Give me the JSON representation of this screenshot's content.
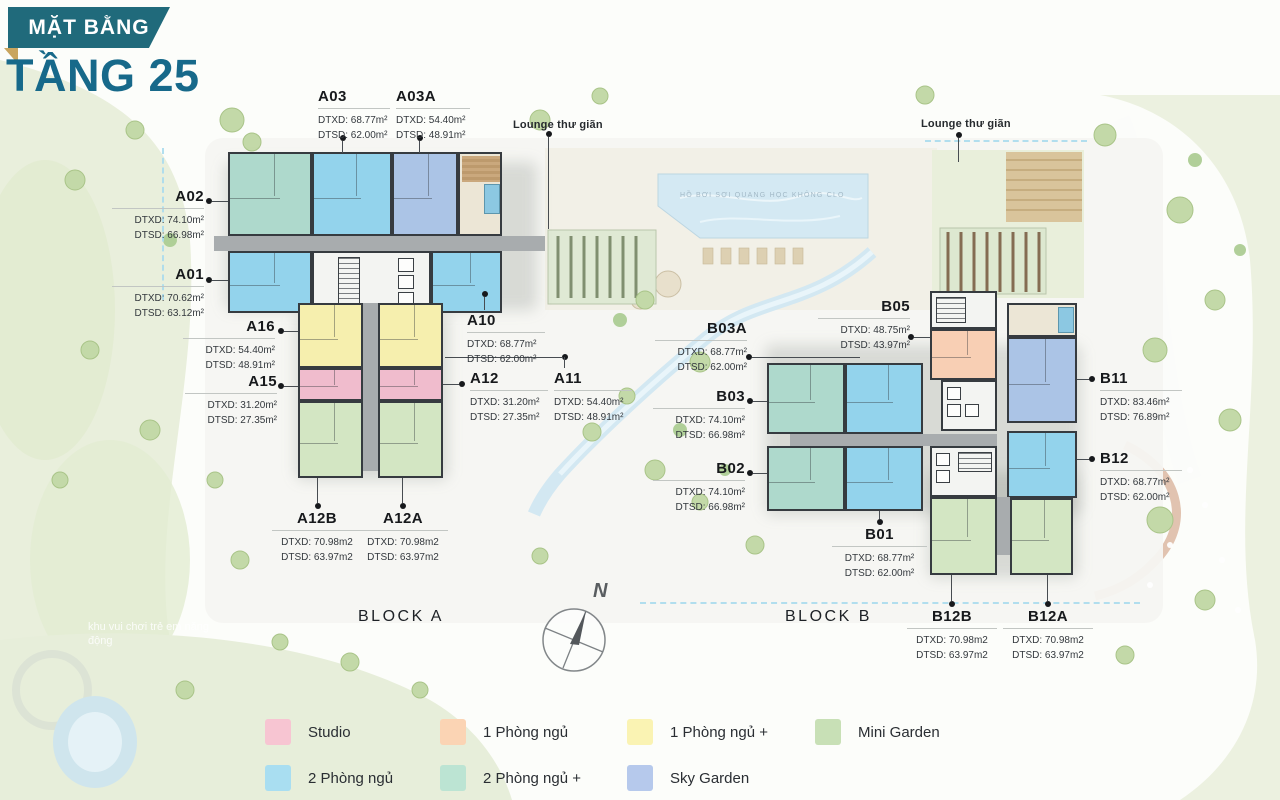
{
  "title": {
    "ribbon": "MẶT BẰNG",
    "floor": "TẦNG 25"
  },
  "annotations": {
    "lounge_left": "Lounge thư giãn",
    "lounge_right": "Lounge thư giãn",
    "block_a": "BLOCK A",
    "block_b": "BLOCK B",
    "compass_north": "N",
    "pool_caption": "HỒ BƠI SỢI QUANG HỌC KHÔNG CLO",
    "playground_caption": "khu vui chơi trẻ em năng động"
  },
  "units": {
    "A01": {
      "name": "A01",
      "dtxd": "DTXD: 70.62m²",
      "dtsd": "DTSD: 63.12m²"
    },
    "A02": {
      "name": "A02",
      "dtxd": "DTXD: 74.10m²",
      "dtsd": "DTSD: 66.98m²"
    },
    "A03": {
      "name": "A03",
      "dtxd": "DTXD: 68.77m²",
      "dtsd": "DTSD: 62.00m²"
    },
    "A03A": {
      "name": "A03A",
      "dtxd": "DTXD: 54.40m²",
      "dtsd": "DTSD: 48.91m²"
    },
    "A10": {
      "name": "A10",
      "dtxd": "DTXD: 68.77m²",
      "dtsd": "DTSD: 62.00m²"
    },
    "A11": {
      "name": "A11",
      "dtxd": "DTXD: 54.40m²",
      "dtsd": "DTSD: 48.91m²"
    },
    "A12": {
      "name": "A12",
      "dtxd": "DTXD: 31.20m²",
      "dtsd": "DTSD: 27.35m²"
    },
    "A15": {
      "name": "A15",
      "dtxd": "DTXD: 31.20m²",
      "dtsd": "DTSD: 27.35m²"
    },
    "A16": {
      "name": "A16",
      "dtxd": "DTXD: 54.40m²",
      "dtsd": "DTSD: 48.91m²"
    },
    "A12B": {
      "name": "A12B",
      "dtxd": "DTXD: 70.98m2",
      "dtsd": "DTSD: 63.97m2"
    },
    "A12A": {
      "name": "A12A",
      "dtxd": "DTXD: 70.98m2",
      "dtsd": "DTSD: 63.97m2"
    },
    "B01": {
      "name": "B01",
      "dtxd": "DTXD: 68.77m²",
      "dtsd": "DTSD: 62.00m²"
    },
    "B02": {
      "name": "B02",
      "dtxd": "DTXD: 74.10m²",
      "dtsd": "DTSD: 66.98m²"
    },
    "B03": {
      "name": "B03",
      "dtxd": "DTXD: 74.10m²",
      "dtsd": "DTSD: 66.98m²"
    },
    "B03A": {
      "name": "B03A",
      "dtxd": "DTXD: 68.77m²",
      "dtsd": "DTSD: 62.00m²"
    },
    "B05": {
      "name": "B05",
      "dtxd": "DTXD: 48.75m²",
      "dtsd": "DTSD: 43.97m²"
    },
    "B11": {
      "name": "B11",
      "dtxd": "DTXD: 83.46m²",
      "dtsd": "DTSD: 76.89m²"
    },
    "B12": {
      "name": "B12",
      "dtxd": "DTXD: 68.77m²",
      "dtsd": "DTSD: 62.00m²"
    },
    "B12B": {
      "name": "B12B",
      "dtxd": "DTXD: 70.98m2",
      "dtsd": "DTSD: 63.97m2"
    },
    "B12A": {
      "name": "B12A",
      "dtxd": "DTXD: 70.98m2",
      "dtsd": "DTSD: 63.97m2"
    }
  },
  "legend": {
    "items": [
      {
        "label": "Studio",
        "color": "#f7c5d2"
      },
      {
        "label": "1 Phòng ngủ",
        "color": "#fbd4b4"
      },
      {
        "label": "1 Phòng ngủ +",
        "color": "#faf3b3"
      },
      {
        "label": "Mini Garden",
        "color": "#c8e0b6"
      },
      {
        "label": "2 Phòng ngủ",
        "color": "#a9def1"
      },
      {
        "label": "2 Phòng ngủ +",
        "color": "#bce4d3"
      },
      {
        "label": "Sky Garden",
        "color": "#b6c9ec"
      }
    ]
  },
  "colors": {
    "brand_teal": "#206a7b",
    "title_teal": "#17698a",
    "ribbon_fold_gold": "#c9a55e"
  }
}
